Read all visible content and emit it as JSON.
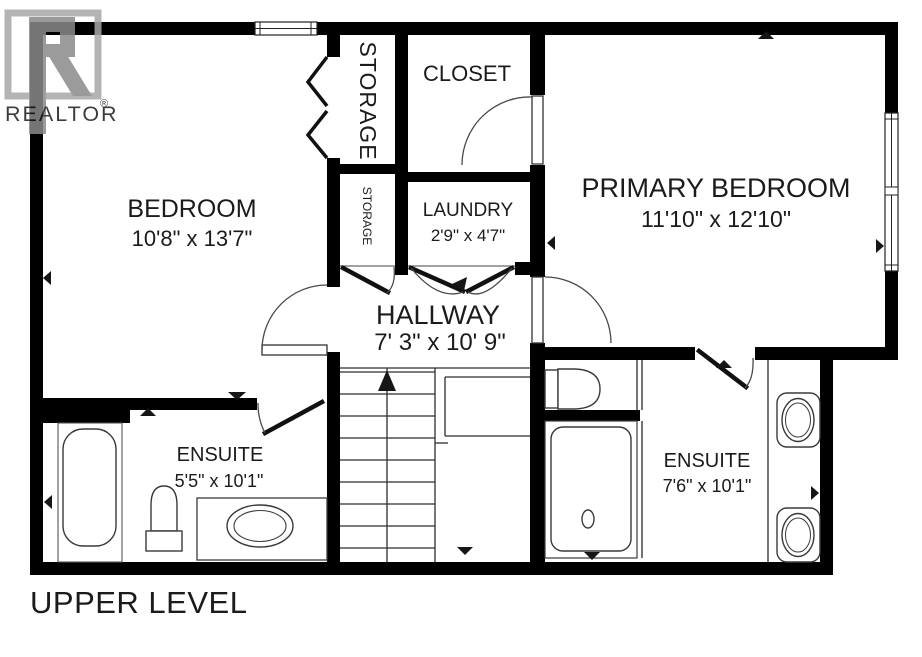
{
  "plan": {
    "level_label": "UPPER LEVEL",
    "watermark": {
      "logo_text": "REALTOR",
      "registered_mark": "®"
    },
    "rooms": {
      "bedroom": {
        "name": "BEDROOM",
        "dims": "10'8\" x 13'7\""
      },
      "primary": {
        "name": "PRIMARY BEDROOM",
        "dims": "11'10\" x 12'10\""
      },
      "hallway": {
        "name": "HALLWAY",
        "dims": "7' 3\" x 10' 9\""
      },
      "closet": {
        "name": "CLOSET"
      },
      "laundry": {
        "name": "LAUNDRY",
        "dims": "2'9\" x 4'7\""
      },
      "storage_large": {
        "name": "STORAGE"
      },
      "storage_small": {
        "name": "STORAGE"
      },
      "ensuite_left": {
        "name": "ENSUITE",
        "dims": "5'5\" x 10'1\""
      },
      "ensuite_right": {
        "name": "ENSUITE",
        "dims": "7'6\" x 10'1\""
      }
    },
    "colors": {
      "wall": "#000000",
      "fixture_line": "#3a3a3a",
      "text": "#1b1b1b",
      "watermark_gray": "#9a9a9a",
      "background": "#ffffff"
    }
  }
}
